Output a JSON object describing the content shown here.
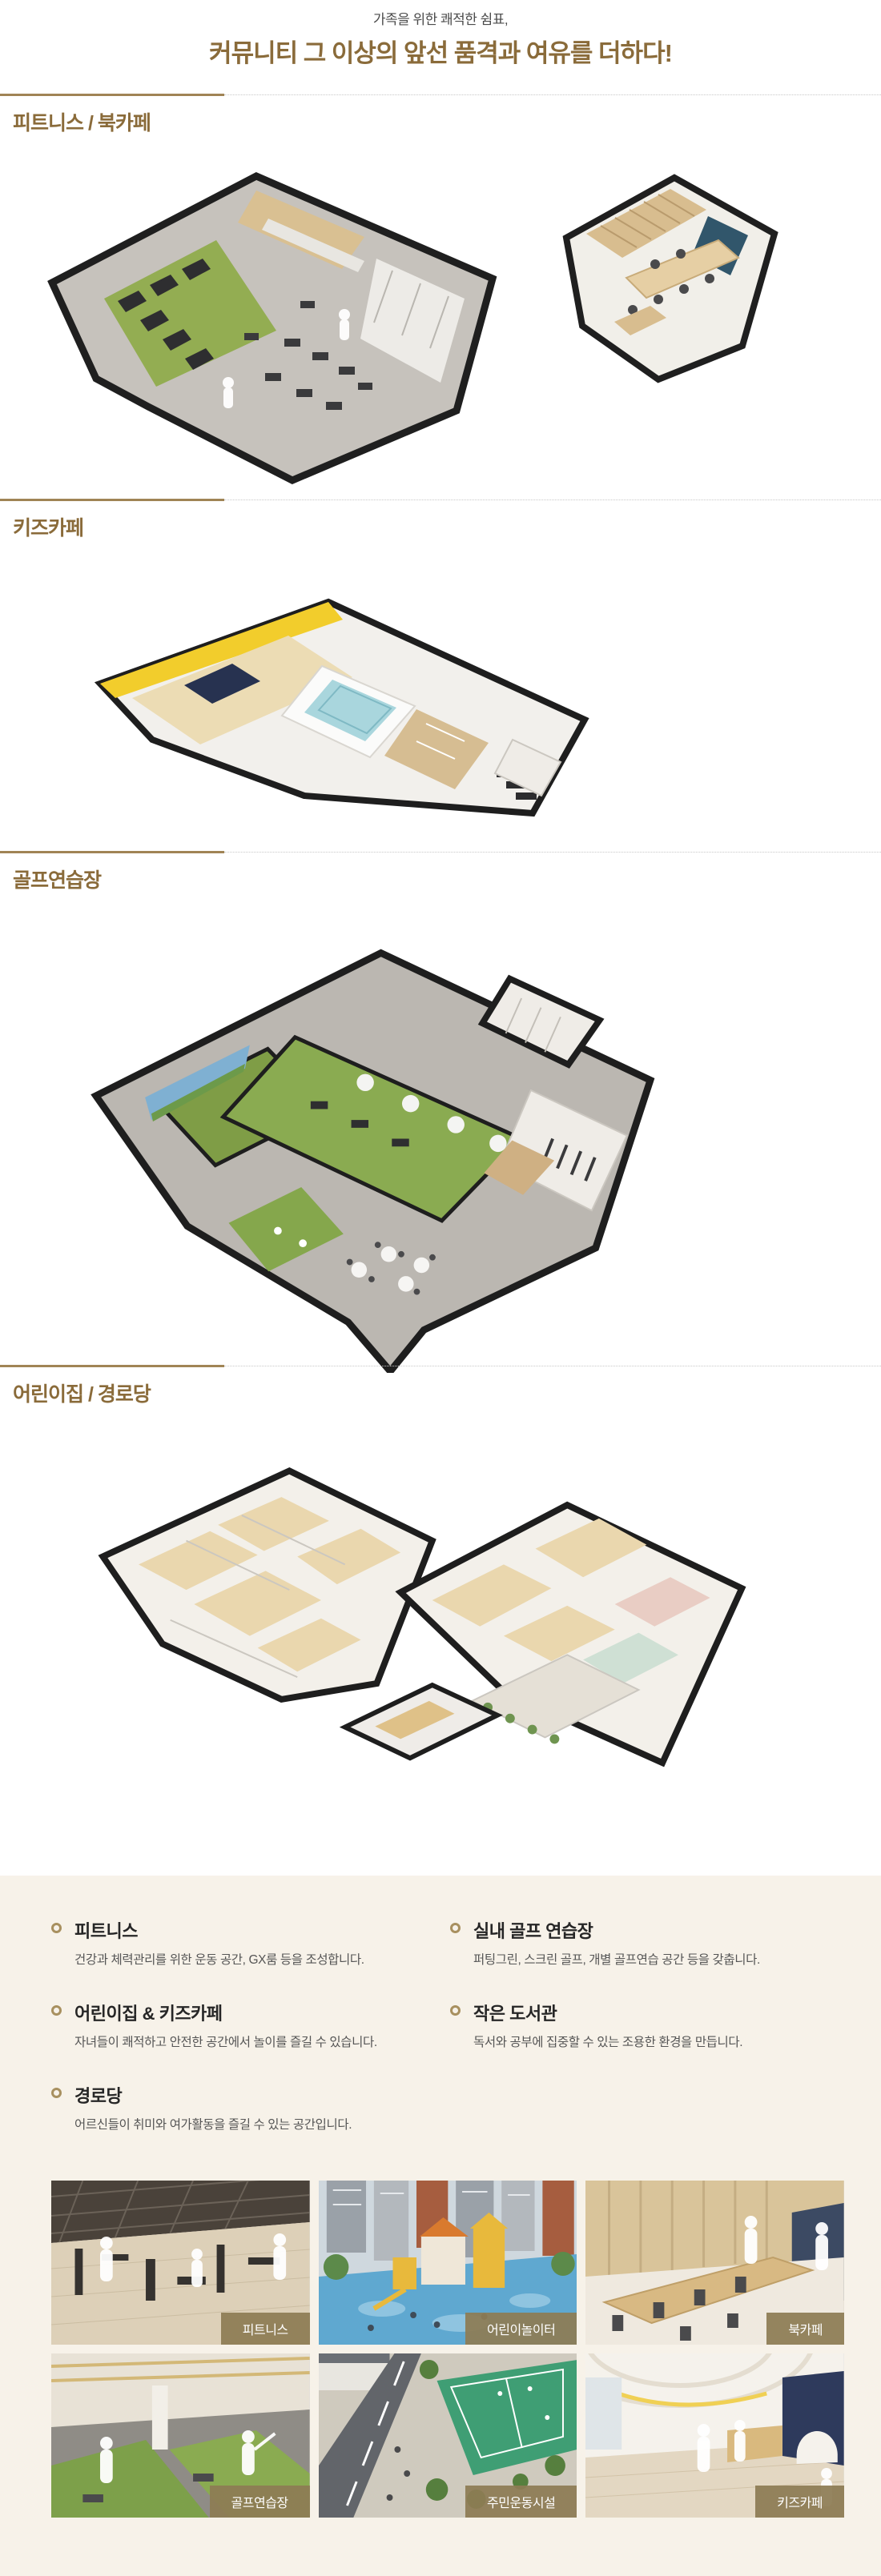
{
  "page": {
    "subtitle": "가족을 위한 쾌적한 쉼표,",
    "title": "커뮤니티 그 이상의 앞선 품격과 여유를 더하다!"
  },
  "sections": [
    {
      "label": "피트니스 / 북카페"
    },
    {
      "label": "키즈카페"
    },
    {
      "label": "골프연습장"
    },
    {
      "label": "어린이집 / 경로당"
    }
  ],
  "features": {
    "left": [
      {
        "title": "피트니스",
        "desc": "건강과 체력관리를 위한 운동 공간, GX룸 등을 조성합니다."
      },
      {
        "title": "어린이집 & 키즈카페",
        "desc": "자녀들이 쾌적하고 안전한 공간에서 놀이를 즐길 수 있습니다."
      },
      {
        "title": "경로당",
        "desc": "어르신들이 취미와 여가활동을 즐길 수 있는 공간입니다."
      }
    ],
    "right": [
      {
        "title": "실내 골프 연습장",
        "desc": "퍼팅그린, 스크린 골프, 개별 골프연습 공간 등을 갖춥니다."
      },
      {
        "title": "작은 도서관",
        "desc": "독서와 공부에 집중할 수 있는 조용한 환경을 만듭니다."
      }
    ]
  },
  "gallery": [
    {
      "label": "피트니스"
    },
    {
      "label": "어린이놀이터"
    },
    {
      "label": "북카페"
    },
    {
      "label": "골프연습장"
    },
    {
      "label": "주민운동시설"
    },
    {
      "label": "키즈카페"
    }
  ],
  "colors": {
    "accent_brown": "#8a6b3a",
    "divider_gold": "#a08455",
    "panel_beige": "#f7f2e9",
    "label_tan": "#8d7c54",
    "bullet_ring": "#a8905f"
  }
}
